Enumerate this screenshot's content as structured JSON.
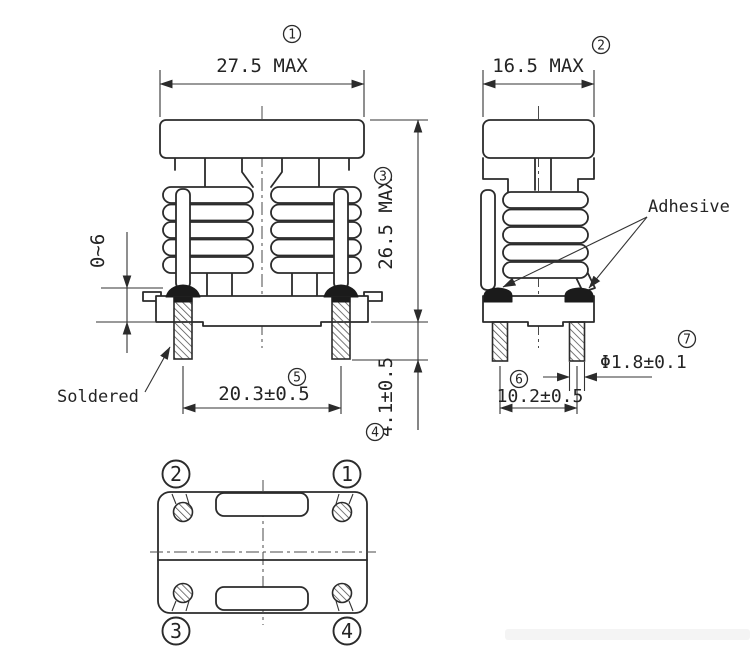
{
  "colors": {
    "line": "#2b2b2b",
    "solder_fill": "#1b1b1b",
    "adhesive_fill": "#1b1b1b",
    "background": "#ffffff"
  },
  "dimensions": {
    "width_front": {
      "index": "1",
      "value": "27.5 MAX"
    },
    "width_side": {
      "index": "2",
      "value": "16.5 MAX"
    },
    "height": {
      "index": "3",
      "value": "26.5 MAX"
    },
    "pin_length": {
      "index": "4",
      "value": "4.1±0.5"
    },
    "pin_pitch_front": {
      "index": "5",
      "value": "20.3±0.5"
    },
    "pin_pitch_side": {
      "index": "6",
      "value": "10.2±0.5"
    },
    "pin_diameter": {
      "index": "7",
      "value": "Φ1.8±0.1"
    },
    "standoff": {
      "value": "0~6"
    }
  },
  "labels": {
    "soldered": "Soldered",
    "adhesive": "Adhesive"
  },
  "pin_numbers": {
    "p1": "1",
    "p2": "2",
    "p3": "3",
    "p4": "4"
  }
}
